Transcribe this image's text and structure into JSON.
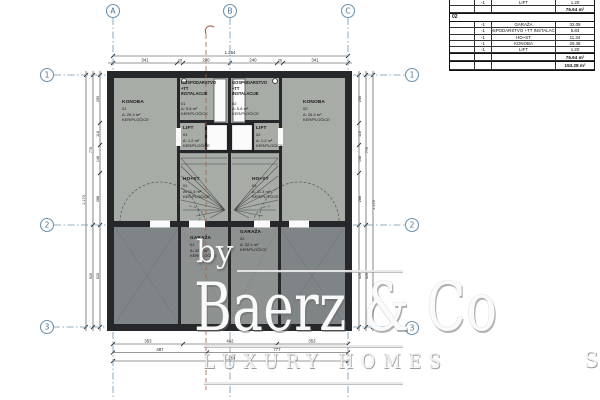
{
  "table": {
    "pre_rows": [
      {
        "qty": "-1",
        "label": "LIFT",
        "value": "1.20"
      }
    ],
    "pre_subtotal": "76.64 m²",
    "section_label": "02",
    "rows": [
      {
        "qty": "-1",
        "label": "GARAŽA",
        "value": "32.09"
      },
      {
        "qty": "-1",
        "label": "GOSPODARSTVO +TT INSTALACIJE",
        "value": "5.83"
      },
      {
        "qty": "-1",
        "label": "HO+ST",
        "value": "11.34"
      },
      {
        "qty": "-1",
        "label": "KONOBA",
        "value": "26.38"
      },
      {
        "qty": "-1",
        "label": "LIFT",
        "value": "1.20"
      }
    ],
    "subtotal": "76.64 m²",
    "total": "153.28 m²"
  },
  "grid": {
    "cols": [
      "A",
      "B",
      "C"
    ],
    "rows": [
      "1",
      "2",
      "3"
    ]
  },
  "dims": {
    "top_total": "1.264",
    "top_segs": [
      "341",
      "26",
      "240",
      "240",
      "26",
      "341"
    ],
    "bot1": [
      "353",
      "492",
      "353"
    ],
    "bot2": [
      "487",
      "777"
    ],
    "bot_total": "1.264",
    "side_segs": [
      "250",
      "116",
      "146",
      "288",
      "520"
    ],
    "side_span": "775",
    "side_total": "1.170"
  },
  "rooms": [
    {
      "name": "KONOBA",
      "num": "01",
      "area": "A: 26.4 m²",
      "finish": "KER/PLOČICE"
    },
    {
      "name": "KONOBA",
      "num": "02",
      "area": "A: 26.4 m²",
      "finish": "KER/PLOČICE"
    },
    {
      "name": "GOSPODARSTVO",
      "name2": "+TT INSTALACIJE",
      "num": "01",
      "area": "A: 5.8 m²",
      "finish": "KER/PLOČICE"
    },
    {
      "name": "GOSPODARSTVO",
      "name2": "+TT INSTALACIJE",
      "num": "02",
      "area": "A: 5.8 m²",
      "finish": "KER/PLOČICE"
    },
    {
      "name": "LIFT",
      "num": "01",
      "area": "A: 1.2 m²",
      "finish": "KER/PLOČICE"
    },
    {
      "name": "LIFT",
      "num": "02",
      "area": "A: 1.2 m²",
      "finish": "KER/PLOČICE"
    },
    {
      "name": "HO+ST",
      "num": "01",
      "area": "A: 11.3 m²",
      "finish": "KER/PLOČICE"
    },
    {
      "name": "HO+ST",
      "num": "02",
      "area": "A: 11.3 m²",
      "finish": "KER/PLOČICE"
    },
    {
      "name": "GARAŽA",
      "num": "01",
      "area": "A: 32.1 m²",
      "finish": "KER/PLOČICE"
    },
    {
      "name": "GARAŽA",
      "num": "02",
      "area": "A: 32.1 m²",
      "finish": "KER/PLOČICE"
    }
  ],
  "watermark": {
    "by": "by",
    "brand": "Baerz & Co",
    "tagline": "LUXURY HOMES",
    "fragment": "S"
  },
  "colors": {
    "grid_blue": "#6e93b0",
    "wall": "#26272b",
    "room_light": "#a8aca6",
    "room_dark": "#7f8487",
    "room_mid": "#8d9190",
    "accent_red": "#a2604c"
  }
}
